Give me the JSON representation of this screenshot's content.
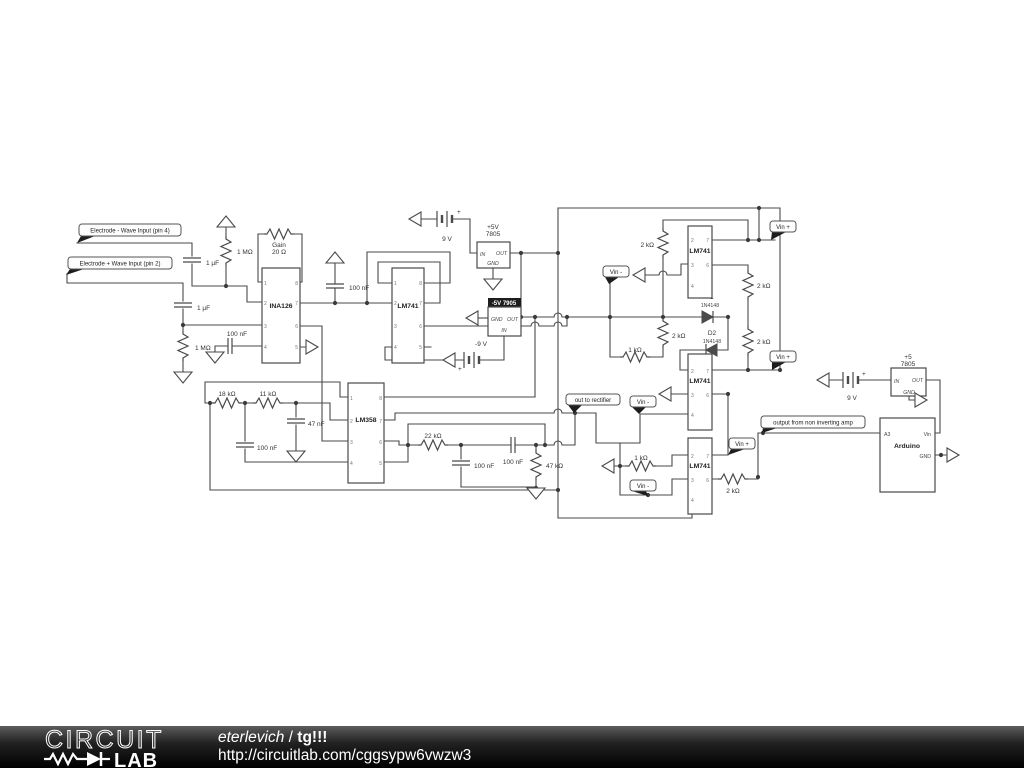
{
  "page": {
    "bg": "#ffffff",
    "wire_color": "#4a4a4a",
    "flag_tail_color": "#1d1d1d"
  },
  "schematic": {
    "flags": {
      "electrode_minus": "Electrode - Wave Input (pin 4)",
      "electrode_plus": "Electrode + Wave Input (pin 2)",
      "out_to_rectifier": "out to rectifier",
      "output_noninv": "output from non inverting amp",
      "vin_plus": "Vin +",
      "vin_minus": "Vin -"
    },
    "ic": {
      "ina126": "INA126",
      "lm741": "LM741",
      "lm358": "LM358",
      "arduino": "Arduino"
    },
    "pins": {
      "p1": "1",
      "p2": "2",
      "p3": "3",
      "p4": "4",
      "p5": "5",
      "p6": "6",
      "p7": "7",
      "p8": "8"
    },
    "arduino_pins": {
      "a3": "A3",
      "vin": "Vin",
      "gnd": "GND"
    },
    "reg": {
      "in": "IN",
      "out": "OUT",
      "gnd": "GND",
      "pos_title": "+5V",
      "pos_part": "7805",
      "neg_title": "-5V 7905",
      "pos2_title": "+5",
      "pos2_part": "7805"
    },
    "batt": {
      "v9": "9 V",
      "vneg9": "-9 V",
      "plus": "+"
    },
    "values": {
      "c1uf": "1 µF",
      "r1m": "1 MΩ",
      "c100nf": "100 nF",
      "c47nf": "47 nF",
      "r18k": "18 kΩ",
      "r11k": "11 kΩ",
      "r22k": "22 kΩ",
      "r47k": "47 kΩ",
      "r2k": "2 kΩ",
      "r1k": "1 kΩ",
      "rgain_l1": "Gain",
      "rgain_l2": "20 Ω",
      "d_part": "1N4148",
      "d1_name": "1",
      "d2_name": "D2"
    }
  },
  "footer": {
    "brand_line1": "CIRCUIT",
    "brand_line2": "LAB",
    "author": "eterlevich",
    "separator": "/",
    "project": "tg!!!",
    "url": "http://circuitlab.com/cggsypw6vwzw3"
  }
}
